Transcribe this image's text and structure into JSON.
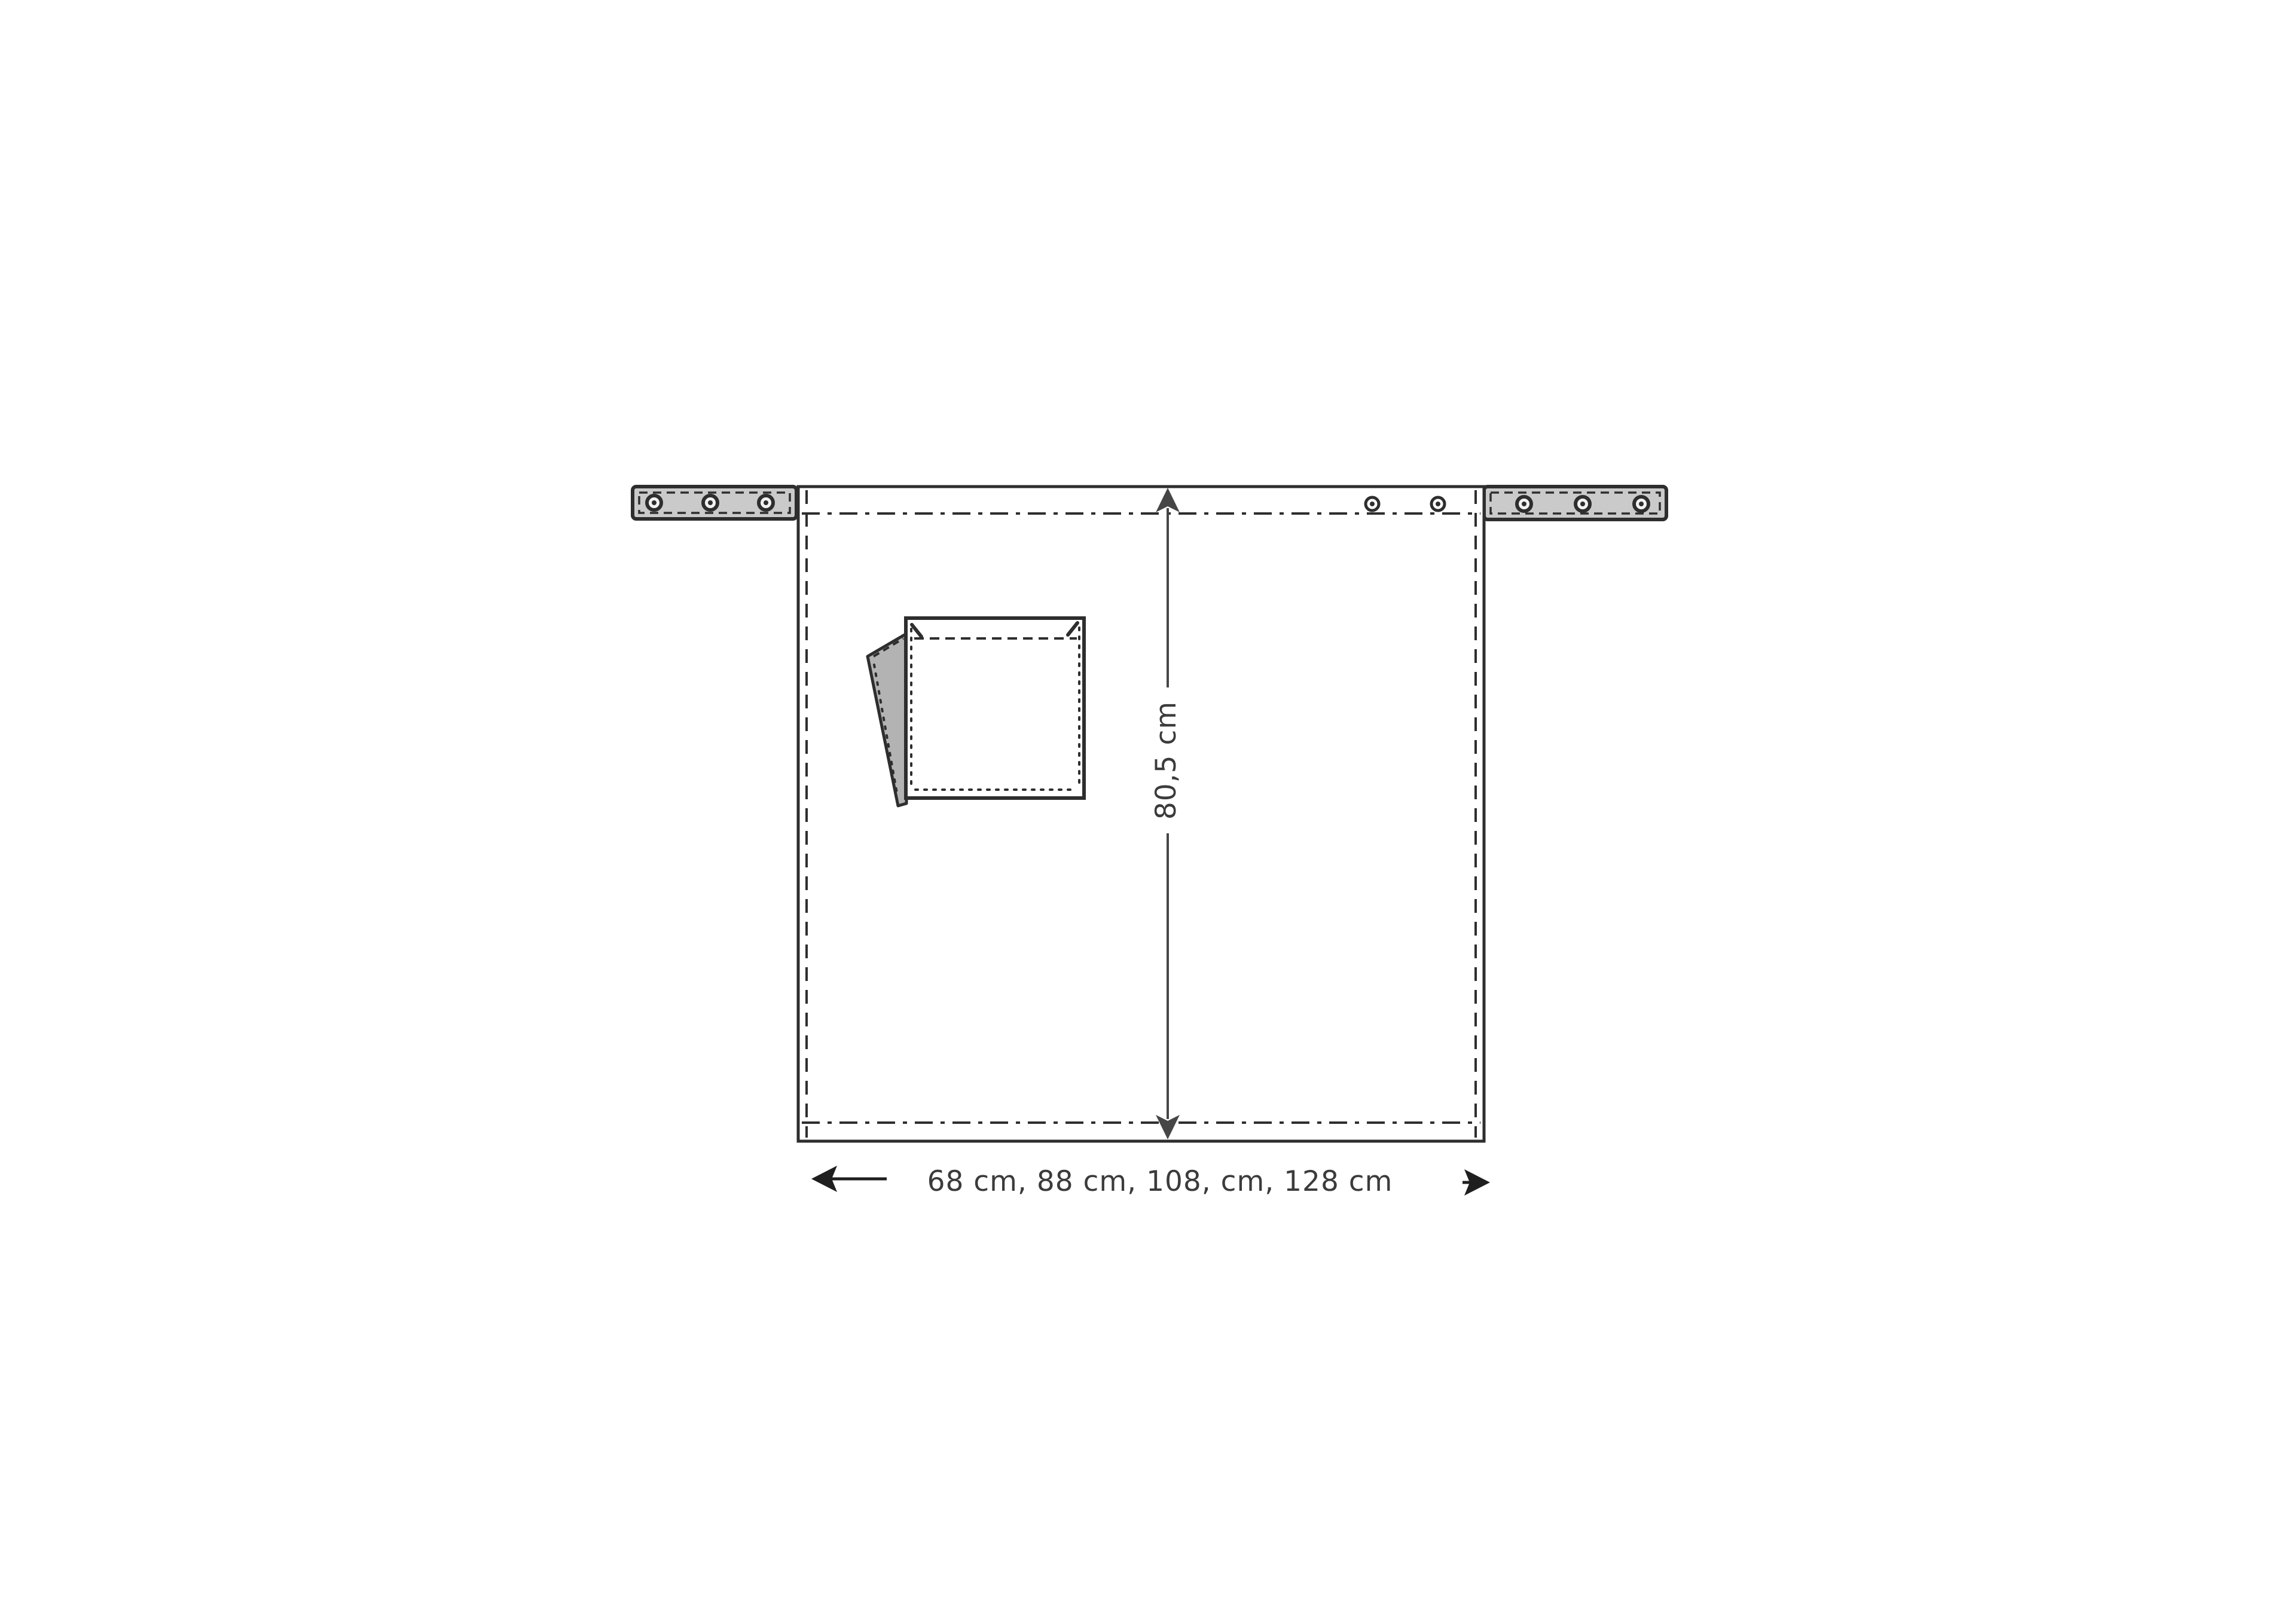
{
  "diagram": {
    "name": "apron-technical-drawing",
    "height_dimension": {
      "label": "80,5 cm"
    },
    "width_dimension": {
      "label": "68 cm, 88 cm, 108, cm, 128 cm"
    },
    "colors": {
      "background": "#ffffff",
      "line": "#2e2e2e",
      "dimension": "#464646",
      "text": "#3b3b3b",
      "strap_fill": "#cacaca",
      "flap_fill": "#b3b3b3"
    }
  }
}
